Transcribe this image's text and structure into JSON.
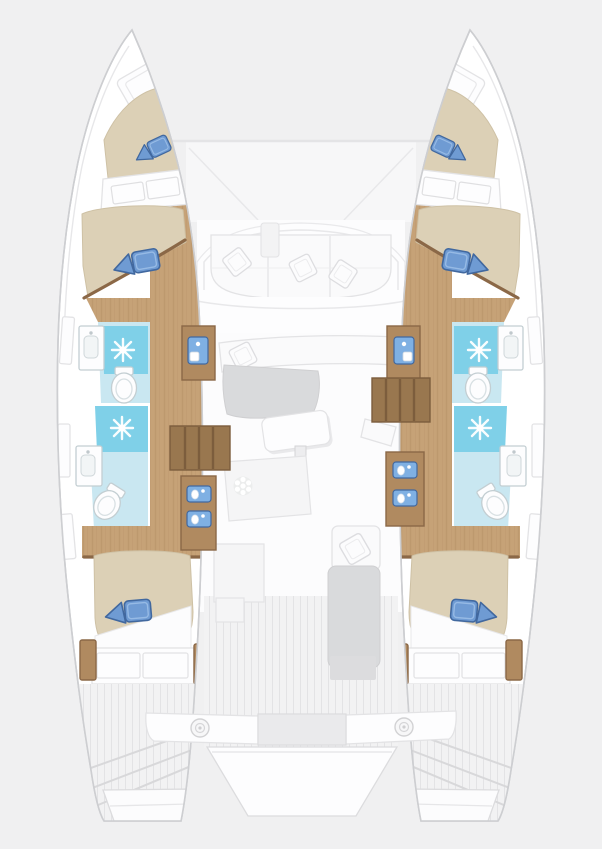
{
  "labels": {
    "plan": "Catamaran interior deck plan, top view, four cabin layout",
    "port_hull": "Port hull (left)",
    "starboard_hull": "Starboard hull (right)",
    "bow_hatch": "Bow locker hatch",
    "forepeak_berth": "Forepeak berth with blue pillows",
    "shelf": "Forward shelf seat",
    "forward_cabin": "Forward cabin double berth",
    "forward_bathroom": "Forward bathroom with shower, washbasin and toilet",
    "aft_bathroom": "Aft bathroom with shower, washbasin and toilet",
    "shower": "Shower tray with drain",
    "toilet": "Toilet",
    "washbasin": "Washbasin cabinet",
    "corridor": "Hull corridor, wood floor",
    "companionway_steps": "Companionway steps down to hull",
    "console": "Cabinet with sink unit",
    "vanity": "Vanity cabinet with twin sinks",
    "aft_cabin": "Aft cabin double berth",
    "aft_bench": "Aft cabin bench seat",
    "foredeck": "Foredeck between hulls",
    "forward_cockpit": "Forward cockpit sofa with pillows",
    "walkway": "Forward walkway",
    "saloon": "Saloon",
    "saloon_sofa": "Saloon sofa",
    "chaise": "Saloon chaise cushion",
    "dining_table": "Dining table",
    "galley": "Galley counter with stove burner",
    "galley_units": "Galley units",
    "nav_seat": "Aft facing seat with pillow",
    "side_bench": "Cockpit side bench",
    "engine_hatch": "Deck hatch",
    "aft_cockpit": "Aft cockpit deck",
    "stern_bench": "Stern crossbench with winches",
    "winch": "Winch",
    "stern_platform": "Stern platform between hulls",
    "swim_steps": "Transom swim steps",
    "hull_window": "Hull window"
  },
  "inventory": {
    "double_berths": 4,
    "forepeak_berths": 2,
    "showers": 4,
    "toilets": 4,
    "washbasins": 4,
    "vanity_sinks": 6,
    "companionway_steps": 2,
    "stove_burners": 1,
    "dining_tables": 1,
    "winches": 2,
    "blue_pillow_pairs": 6,
    "white_pillows": 5
  },
  "icons": [
    "shower-drain-icon",
    "stove-burner-icon",
    "winch-icon",
    "toilet-icon",
    "washbasin-icon",
    "sink-icon",
    "steps-icon",
    "pillow-icon",
    "hatch-icon"
  ],
  "colors": {
    "background": "#f0f0f1",
    "hull_fill": "#ffffff",
    "hull_stroke": "#cdced1",
    "inner_line": "#e7e7e9",
    "wood": "#c6a277",
    "wood_grain": "#b48f66",
    "wood_dark": "#8b6847",
    "step_wood": "#99774f",
    "step_slat": "#7c5d3d",
    "bed": "#dcd0b6",
    "bed_shade": "#cec1a5",
    "pillow": "#6f9bd3",
    "pillow_dark": "#41689f",
    "pillow_light": "#9dbfe8",
    "bath_floor": "#c9e7f1",
    "shower": "#7fd0e8",
    "fixture_white": "#fdfdfe",
    "fixture_stroke": "#c3ced2",
    "sofa": "#fafafb",
    "sofa_stroke": "#e3e3e5",
    "cushion_gray": "#d9dadc",
    "plank": "#f2f2f3",
    "plank_line": "#e3e3e5",
    "screen_blue": "#7fb0e3",
    "counter": "#f5f5f6",
    "hatch_gray": "#dcdcde"
  }
}
